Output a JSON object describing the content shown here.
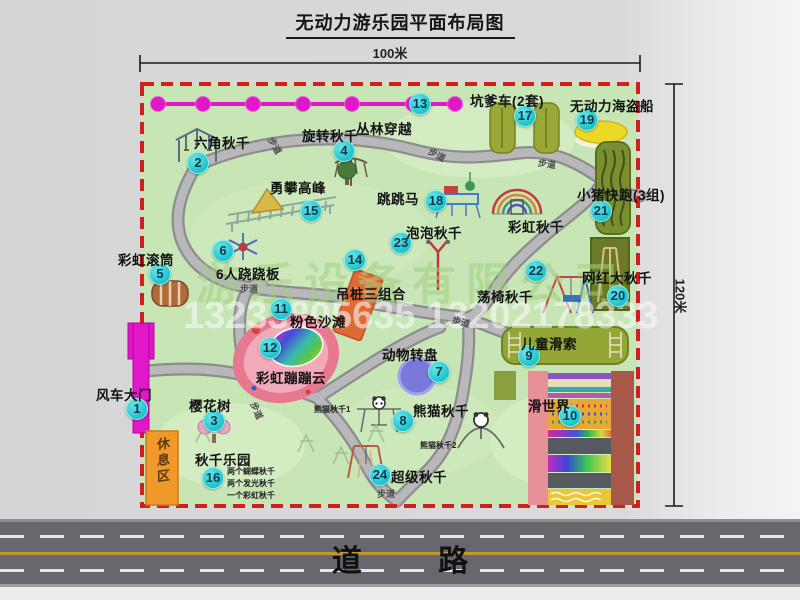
{
  "title": "无动力游乐园平面布局图",
  "dimensions": {
    "width": "100米",
    "height": "120米"
  },
  "road": {
    "label": "道 路"
  },
  "watermark": {
    "company": "游乐设备有限公司",
    "phone": "13233805635 13202178333"
  },
  "map": {
    "rest_area": {
      "label": "休息区"
    },
    "path_label_text": "步道",
    "path_labels": [
      {
        "x": 266,
        "y": 139,
        "rot": 60
      },
      {
        "x": 428,
        "y": 148,
        "rot": 28
      },
      {
        "x": 538,
        "y": 157,
        "rot": 8
      },
      {
        "x": 240,
        "y": 282,
        "rot": 0
      },
      {
        "x": 452,
        "y": 315,
        "rot": 15
      },
      {
        "x": 248,
        "y": 404,
        "rot": 66
      },
      {
        "x": 377,
        "y": 487,
        "rot": 0
      }
    ],
    "colors": {
      "map_green": "#c7e5b5",
      "border_red": "#cf2020",
      "badge_cyan": "#1cc2cc",
      "zipline_magenta": "#e018c8",
      "road_gray": "#67676e",
      "rest_orange": "#f0982a"
    },
    "attractions": [
      {
        "num": 1,
        "label": "风车大门",
        "badge": [
          137,
          409
        ],
        "label_pos": [
          96,
          384
        ],
        "icon": "windmill-gate"
      },
      {
        "num": 2,
        "label": "六角秋千",
        "badge": [
          198,
          163
        ],
        "label_pos": [
          194,
          132
        ],
        "icon": "hexagon-swing"
      },
      {
        "num": 3,
        "label": "樱花树",
        "badge": [
          214,
          421
        ],
        "label_pos": [
          189,
          395
        ],
        "icon": "cherry-tree"
      },
      {
        "num": 4,
        "label": "旋转秋千",
        "badge": [
          344,
          151
        ],
        "label_pos": [
          302,
          125
        ],
        "icon": "rotating-swing"
      },
      {
        "num": 5,
        "label": "彩虹滚筒",
        "badge": [
          160,
          274
        ],
        "label_pos": [
          118,
          249
        ],
        "icon": "rainbow-roller"
      },
      {
        "num": 6,
        "label": "6人跷跷板",
        "badge": [
          223,
          251
        ],
        "label_pos": [
          216,
          263
        ],
        "icon": "seesaw"
      },
      {
        "num": 7,
        "label": "动物转盘",
        "badge": [
          439,
          372
        ],
        "label_pos": [
          382,
          344
        ],
        "icon": "animal-turntable"
      },
      {
        "num": 8,
        "label": "熊猫秋千",
        "badge": [
          403,
          421
        ],
        "label_pos": [
          413,
          400
        ],
        "icon": "panda-swing",
        "subs": [
          {
            "text": "熊猫秋千1",
            "x": 314,
            "y": 404
          },
          {
            "text": "熊猫秋千2",
            "x": 420,
            "y": 440
          }
        ]
      },
      {
        "num": 9,
        "label": "儿童滑索",
        "badge": [
          529,
          356
        ],
        "label_pos": [
          521,
          333
        ],
        "icon": "kids-zipline"
      },
      {
        "num": 10,
        "label": "滑世界",
        "badge": [
          570,
          416
        ],
        "label_pos": [
          528,
          395
        ],
        "icon": "slide-world"
      },
      {
        "num": 11,
        "label": "粉色沙滩",
        "badge": [
          281,
          309
        ],
        "label_pos": [
          290,
          311
        ],
        "icon": "pink-beach"
      },
      {
        "num": 12,
        "label": "彩虹蹦蹦云",
        "badge": [
          270,
          348
        ],
        "label_pos": [
          256,
          367
        ],
        "icon": "rainbow-cloud"
      },
      {
        "num": 13,
        "label": "丛林穿越",
        "badge": [
          420,
          104
        ],
        "label_pos": [
          356,
          118
        ],
        "icon": "jungle-zipline"
      },
      {
        "num": 14,
        "label": "吊桩三组合",
        "badge": [
          355,
          260
        ],
        "label_pos": [
          336,
          283
        ],
        "icon": "hanging-piles"
      },
      {
        "num": 15,
        "label": "勇攀高峰",
        "badge": [
          311,
          211
        ],
        "label_pos": [
          270,
          177
        ],
        "icon": "climbing-peak"
      },
      {
        "num": 16,
        "label": "秋千乐园",
        "badge": [
          213,
          478
        ],
        "label_pos": [
          195,
          449
        ],
        "icon": "swing-park",
        "subs": [
          {
            "text": "两个蝴蝶秋千",
            "x": 227,
            "y": 466
          },
          {
            "text": "两个发光秋千",
            "x": 227,
            "y": 478
          },
          {
            "text": "一个彩虹秋千",
            "x": 227,
            "y": 490
          }
        ]
      },
      {
        "num": 17,
        "label": "坑爹车(2套)",
        "badge": [
          525,
          116
        ],
        "label_pos": [
          470,
          90
        ],
        "icon": "pit-cart-tracks"
      },
      {
        "num": 18,
        "label": "跳跳马",
        "badge": [
          436,
          201
        ],
        "label_pos": [
          377,
          188
        ],
        "icon": "jumping-horse"
      },
      {
        "num": 19,
        "label": "无动力海盗船",
        "badge": [
          587,
          120
        ],
        "label_pos": [
          570,
          95
        ],
        "icon": "pirate-ship"
      },
      {
        "num": 20,
        "label": "网红大秋千",
        "badge": [
          618,
          296
        ],
        "label_pos": [
          582,
          267
        ],
        "icon": "big-swing"
      },
      {
        "num": 21,
        "label": "小猪快跑(3组)",
        "badge": [
          601,
          211
        ],
        "label_pos": [
          577,
          184
        ],
        "icon": "piggy-run"
      },
      {
        "num": 22,
        "label": "荡椅秋千",
        "badge": [
          536,
          271
        ],
        "label_pos": [
          477,
          286
        ],
        "icon": "chair-swing"
      },
      {
        "num": 23,
        "label": "泡泡秋千",
        "badge": [
          401,
          243
        ],
        "label_pos": [
          406,
          222
        ],
        "icon": "bubble-swing"
      },
      {
        "num": 24,
        "label": "超级秋千",
        "badge": [
          380,
          475
        ],
        "label_pos": [
          391,
          466
        ],
        "icon": "super-swing"
      },
      {
        "num": null,
        "label": "彩虹秋千",
        "badge": null,
        "label_pos": [
          508,
          216
        ],
        "icon": "rainbow-swing"
      }
    ]
  }
}
